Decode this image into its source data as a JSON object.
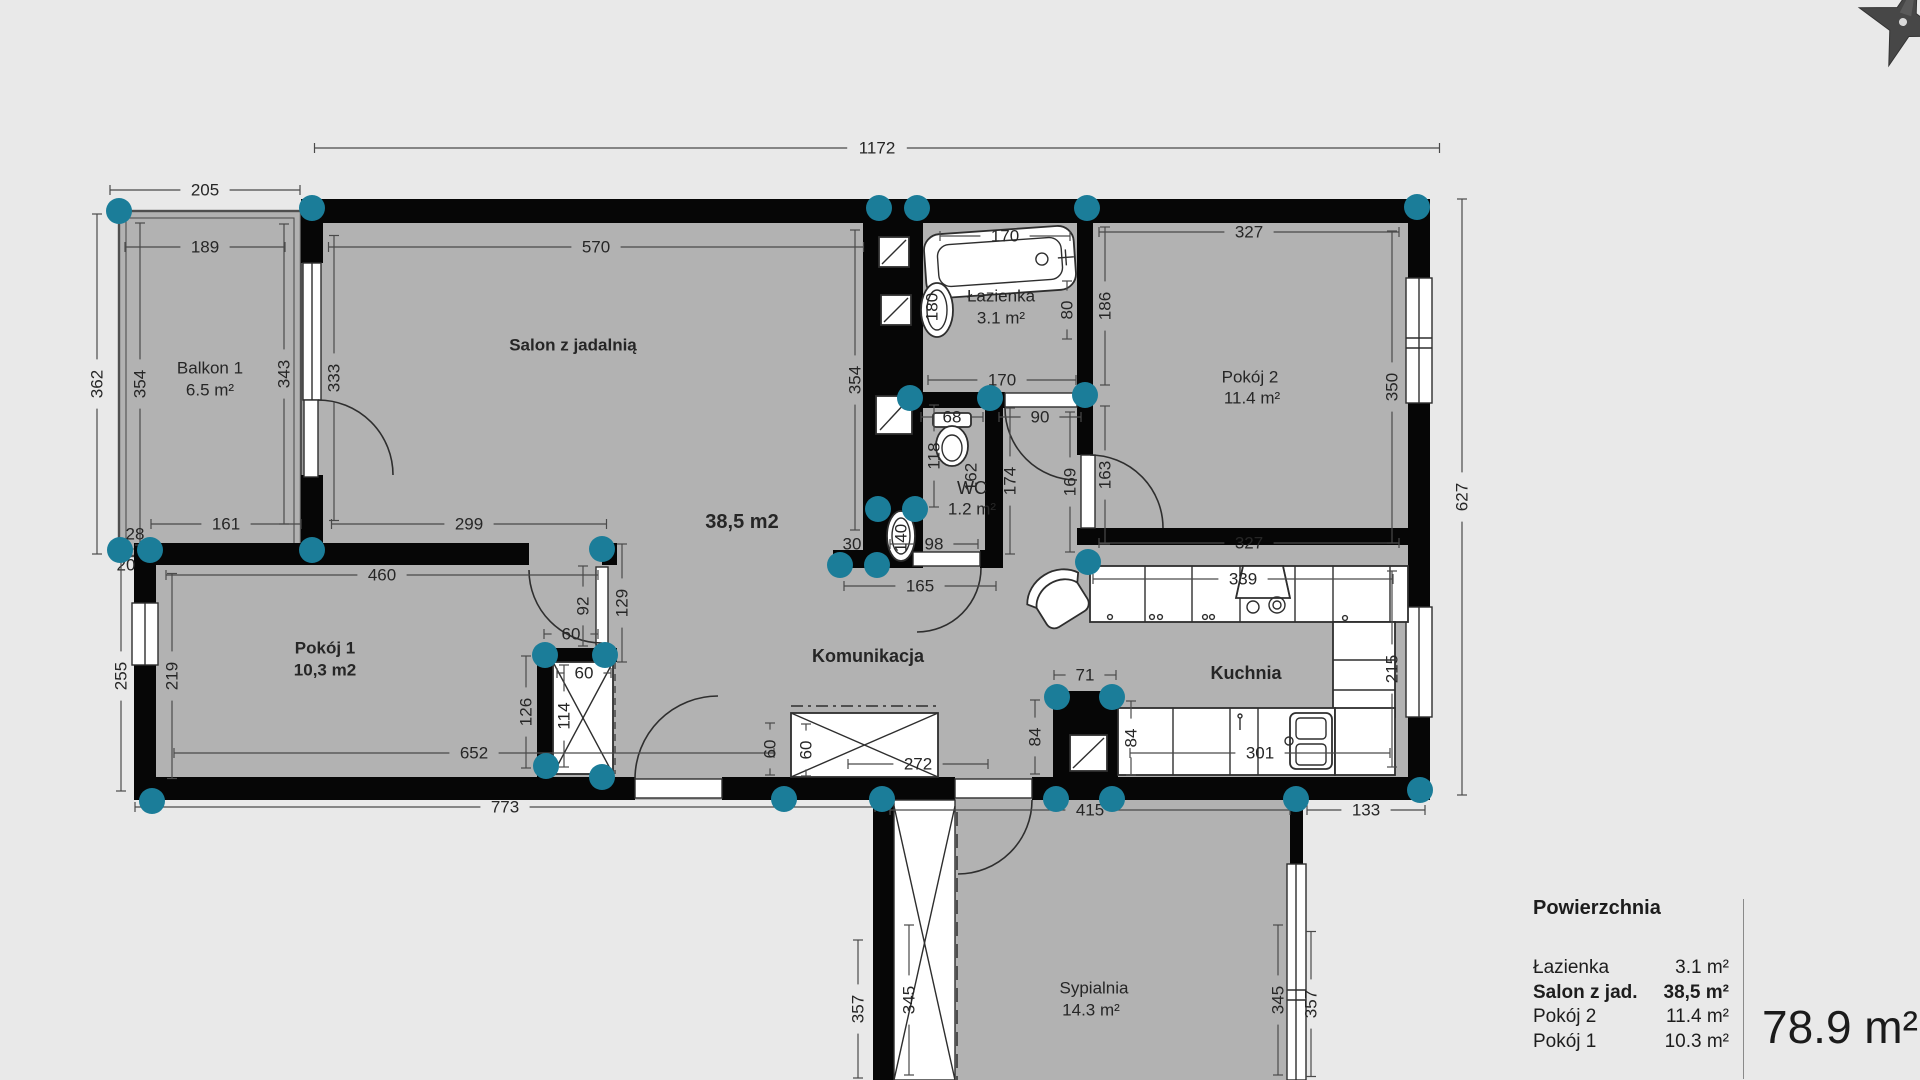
{
  "colors": {
    "background": "#e9e9e9",
    "room_fill": "#b2b2b2",
    "wall": "#060606",
    "handle_teal": "#1b7d99",
    "dim_text": "#262626"
  },
  "icons": {
    "compass": "compass-star-icon",
    "handles": "corner-handle",
    "shafts": "shaft-duct-icon",
    "fixtures": [
      "bathtub-icon",
      "washbasin-icon",
      "toilet-icon",
      "kitchen-sink-icon",
      "stove-icon",
      "hood-icon",
      "wardrobe-icon",
      "armchair-icon"
    ]
  },
  "legend": {
    "title": "Powierzchnia",
    "rows": [
      {
        "label": "Łazienka",
        "value": "3.1 m²",
        "bold": false
      },
      {
        "label": "Salon z jad.",
        "value": "38,5 m²",
        "bold": true
      },
      {
        "label": "Pokój 2",
        "value": "11.4 m²",
        "bold": false
      },
      {
        "label": "Pokój 1",
        "value": "10.3 m²",
        "bold": false
      }
    ],
    "total": "78.9 m²"
  },
  "plan": {
    "labels": [
      {
        "id": "balkon-name",
        "t": "Balkon 1",
        "x": 210,
        "y": 368,
        "size": 17,
        "bold": false
      },
      {
        "id": "balkon-area",
        "t": "6.5 m²",
        "x": 210,
        "y": 390,
        "size": 17,
        "bold": false
      },
      {
        "id": "salon-name",
        "t": "Salon z jadalnią",
        "x": 573,
        "y": 345,
        "size": 17,
        "bold": true
      },
      {
        "id": "salon-area",
        "t": "38,5 m2",
        "x": 742,
        "y": 522,
        "size": 20,
        "bold": true
      },
      {
        "id": "pokoj1-name",
        "t": "Pokój 1",
        "x": 325,
        "y": 648,
        "size": 17,
        "bold": true
      },
      {
        "id": "pokoj1-area",
        "t": "10,3 m2",
        "x": 325,
        "y": 670,
        "size": 17,
        "bold": true
      },
      {
        "id": "lazienka-name",
        "t": "Łazienka",
        "x": 1001,
        "y": 296,
        "size": 17,
        "bold": false
      },
      {
        "id": "lazienka-area",
        "t": "3.1 m²",
        "x": 1001,
        "y": 318,
        "size": 17,
        "bold": false
      },
      {
        "id": "wc-name",
        "t": "WC",
        "x": 972,
        "y": 488,
        "size": 18,
        "bold": false
      },
      {
        "id": "wc-area",
        "t": "1.2 m²",
        "x": 972,
        "y": 509,
        "size": 17,
        "bold": false
      },
      {
        "id": "pokoj2-name",
        "t": "Pokój 2",
        "x": 1250,
        "y": 377,
        "size": 17,
        "bold": false
      },
      {
        "id": "pokoj2-area",
        "t": "11.4 m²",
        "x": 1252,
        "y": 398,
        "size": 17,
        "bold": false
      },
      {
        "id": "komunikacja-name",
        "t": "Komunikacja",
        "x": 868,
        "y": 656,
        "size": 18,
        "bold": true
      },
      {
        "id": "kuchnia-name",
        "t": "Kuchnia",
        "x": 1246,
        "y": 673,
        "size": 18,
        "bold": true
      },
      {
        "id": "sypialnia-name",
        "t": "Sypialnia",
        "x": 1094,
        "y": 988,
        "size": 17,
        "bold": false
      },
      {
        "id": "sypialnia-area",
        "t": "14.3 m²",
        "x": 1091,
        "y": 1010,
        "size": 17,
        "bold": false
      }
    ],
    "dimensions": [
      {
        "t": "205",
        "x": 205,
        "y": 190,
        "o": "h",
        "len": 190
      },
      {
        "t": "189",
        "x": 205,
        "y": 247,
        "o": "h",
        "len": 160
      },
      {
        "t": "1172",
        "x": 877,
        "y": 148,
        "o": "h",
        "len": 1125
      },
      {
        "t": "570",
        "x": 596,
        "y": 247,
        "o": "h",
        "len": 535
      },
      {
        "t": "170",
        "x": 1005,
        "y": 236,
        "o": "h",
        "len": 130
      },
      {
        "t": "327",
        "x": 1249,
        "y": 232,
        "o": "h",
        "len": 300
      },
      {
        "t": "362",
        "x": 97,
        "y": 384,
        "o": "v",
        "len": 340
      },
      {
        "t": "354",
        "x": 140,
        "y": 384,
        "o": "v",
        "len": 322
      },
      {
        "t": "343",
        "x": 284,
        "y": 374,
        "o": "v",
        "len": 300
      },
      {
        "t": "333",
        "x": 334,
        "y": 378,
        "o": "v",
        "len": 285
      },
      {
        "t": "354",
        "x": 855,
        "y": 380,
        "o": "v",
        "len": 300
      },
      {
        "t": "180",
        "x": 932,
        "y": 307,
        "o": "v",
        "len": 54
      },
      {
        "t": "80",
        "x": 1067,
        "y": 310,
        "o": "v",
        "len": 58
      },
      {
        "t": "186",
        "x": 1105,
        "y": 306,
        "o": "v",
        "len": 158
      },
      {
        "t": "170",
        "x": 1002,
        "y": 380,
        "o": "h",
        "len": 148
      },
      {
        "t": "68",
        "x": 952,
        "y": 417,
        "o": "h",
        "len": 62
      },
      {
        "t": "90",
        "x": 1040,
        "y": 417,
        "o": "h",
        "len": 82
      },
      {
        "t": "118",
        "x": 934,
        "y": 456,
        "o": "v",
        "len": 102
      },
      {
        "t": "162",
        "x": 971,
        "y": 477,
        "o": "v",
        "len": 52
      },
      {
        "t": "174",
        "x": 1010,
        "y": 481,
        "o": "v",
        "len": 146
      },
      {
        "t": "169",
        "x": 1070,
        "y": 482,
        "o": "v",
        "len": 140
      },
      {
        "t": "163",
        "x": 1105,
        "y": 475,
        "o": "v",
        "len": 138
      },
      {
        "t": "30",
        "x": 852,
        "y": 544,
        "o": "h",
        "len": 42
      },
      {
        "t": "98",
        "x": 934,
        "y": 544,
        "o": "h",
        "len": 88
      },
      {
        "t": "140",
        "x": 901,
        "y": 538,
        "o": "v",
        "len": 46
      },
      {
        "t": "165",
        "x": 920,
        "y": 586,
        "o": "h",
        "len": 152
      },
      {
        "t": "350",
        "x": 1392,
        "y": 387,
        "o": "v",
        "len": 312
      },
      {
        "t": "627",
        "x": 1462,
        "y": 497,
        "o": "v",
        "len": 596
      },
      {
        "t": "327",
        "x": 1249,
        "y": 543,
        "o": "h",
        "len": 300
      },
      {
        "t": "161",
        "x": 226,
        "y": 524,
        "o": "h",
        "len": 150
      },
      {
        "t": "299",
        "x": 469,
        "y": 524,
        "o": "h",
        "len": 275
      },
      {
        "t": "28",
        "x": 135,
        "y": 534,
        "o": "h",
        "len": 40
      },
      {
        "t": "20",
        "x": 126,
        "y": 565,
        "o": "h",
        "len": 36
      },
      {
        "t": "460",
        "x": 382,
        "y": 575,
        "o": "h",
        "len": 432
      },
      {
        "t": "255",
        "x": 121,
        "y": 676,
        "o": "v",
        "len": 230
      },
      {
        "t": "219",
        "x": 172,
        "y": 676,
        "o": "v",
        "len": 205
      },
      {
        "t": "92",
        "x": 583,
        "y": 606,
        "o": "v",
        "len": 80
      },
      {
        "t": "129",
        "x": 622,
        "y": 603,
        "o": "v",
        "len": 118
      },
      {
        "t": "60",
        "x": 571,
        "y": 634,
        "o": "h",
        "len": 54
      },
      {
        "t": "60",
        "x": 584,
        "y": 673,
        "o": "h",
        "len": 54
      },
      {
        "t": "126",
        "x": 526,
        "y": 712,
        "o": "v",
        "len": 112
      },
      {
        "t": "114",
        "x": 564,
        "y": 716,
        "o": "v",
        "len": 102
      },
      {
        "t": "652",
        "x": 474,
        "y": 753,
        "o": "h",
        "len": 600
      },
      {
        "t": "773",
        "x": 505,
        "y": 807,
        "o": "h",
        "len": 740
      },
      {
        "t": "60",
        "x": 770,
        "y": 749,
        "o": "v",
        "len": 52
      },
      {
        "t": "60",
        "x": 806,
        "y": 750,
        "o": "v",
        "len": 52
      },
      {
        "t": "272",
        "x": 918,
        "y": 764,
        "o": "h",
        "len": 140
      },
      {
        "t": "71",
        "x": 1085,
        "y": 675,
        "o": "h",
        "len": 62
      },
      {
        "t": "84",
        "x": 1035,
        "y": 737,
        "o": "v",
        "len": 74
      },
      {
        "t": "84",
        "x": 1131,
        "y": 738,
        "o": "v",
        "len": 74
      },
      {
        "t": "339",
        "x": 1243,
        "y": 579,
        "o": "h",
        "len": 300
      },
      {
        "t": "215",
        "x": 1392,
        "y": 669,
        "o": "v",
        "len": 196
      },
      {
        "t": "301",
        "x": 1260,
        "y": 753,
        "o": "h",
        "len": 260
      },
      {
        "t": "415",
        "x": 1090,
        "y": 810,
        "o": "h",
        "len": 400
      },
      {
        "t": "133",
        "x": 1366,
        "y": 810,
        "o": "h",
        "len": 118
      },
      {
        "t": "357",
        "x": 858,
        "y": 1009,
        "o": "v",
        "len": 138
      },
      {
        "t": "345",
        "x": 909,
        "y": 1000,
        "o": "v",
        "len": 150
      },
      {
        "t": "345",
        "x": 1278,
        "y": 1000,
        "o": "v",
        "len": 150
      },
      {
        "t": "357",
        "x": 1311,
        "y": 1004,
        "o": "v",
        "len": 145
      }
    ],
    "handles": [
      [
        119,
        211
      ],
      [
        312,
        208
      ],
      [
        879,
        208
      ],
      [
        917,
        208
      ],
      [
        1087,
        208
      ],
      [
        1417,
        207
      ],
      [
        120,
        550
      ],
      [
        150,
        550
      ],
      [
        312,
        550
      ],
      [
        602,
        549
      ],
      [
        545,
        655
      ],
      [
        605,
        655
      ],
      [
        546,
        766
      ],
      [
        602,
        777
      ],
      [
        878,
        509
      ],
      [
        915,
        509
      ],
      [
        840,
        565
      ],
      [
        877,
        565
      ],
      [
        910,
        398
      ],
      [
        990,
        398
      ],
      [
        1085,
        395
      ],
      [
        1088,
        562
      ],
      [
        1057,
        697
      ],
      [
        1112,
        697
      ],
      [
        784,
        799
      ],
      [
        882,
        799
      ],
      [
        1056,
        799
      ],
      [
        1112,
        799
      ],
      [
        1296,
        799
      ],
      [
        152,
        801
      ],
      [
        1420,
        790
      ]
    ]
  }
}
